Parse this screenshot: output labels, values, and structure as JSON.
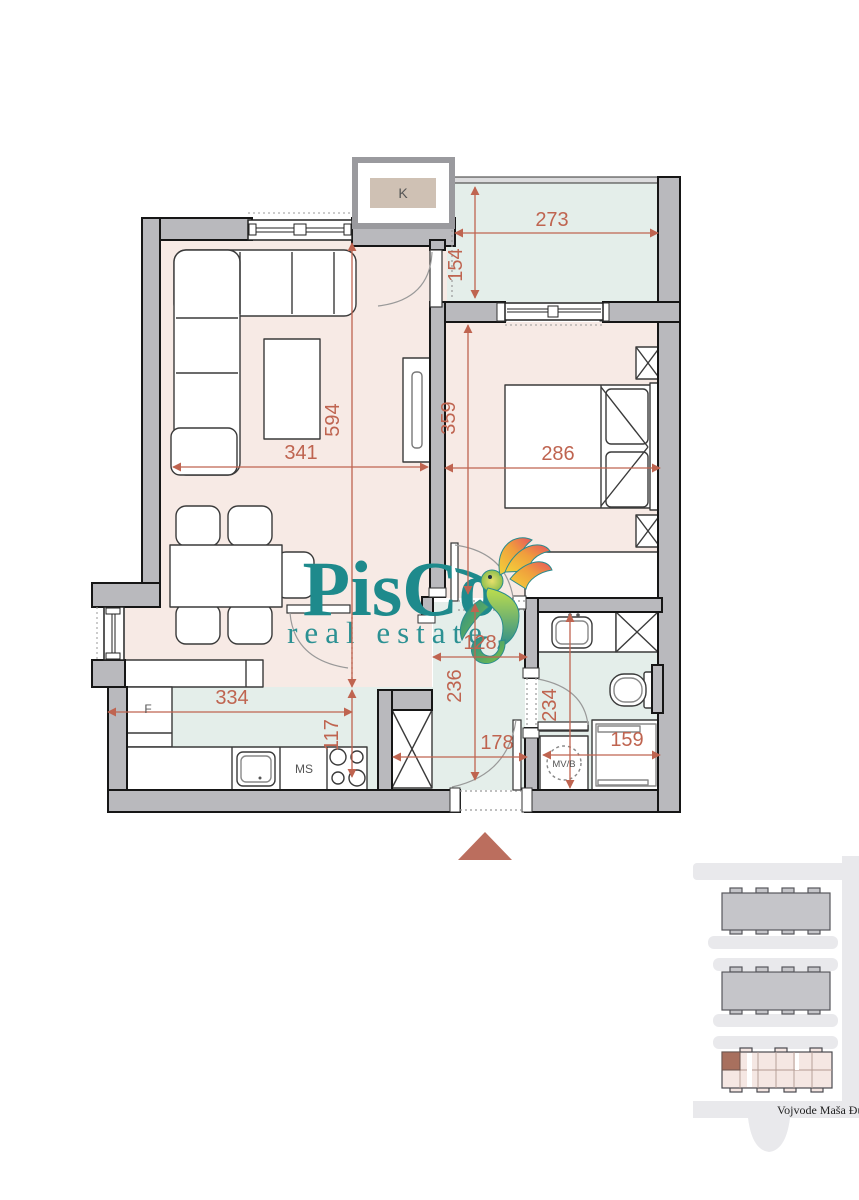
{
  "logo": {
    "brand": "PisCo",
    "tagline": "real estate",
    "accent_color": "#1e8a8c"
  },
  "floor_plan": {
    "appliance_labels": {
      "ac_unit": "K",
      "fridge": "F",
      "dishwasher": "MS",
      "washing_machine": "MV/B"
    },
    "dimensions": {
      "terrace_width": "273",
      "terrace_depth": "154",
      "living_length": "594",
      "living_width": "341",
      "bedroom_length": "359",
      "bedroom_width": "286",
      "hall_width": "128",
      "hall_length": "236",
      "entry_width": "178",
      "kitchen_width": "334",
      "kitchen_depth": "117",
      "bathroom_length": "234",
      "bathroom_width": "159"
    },
    "dimension_color": "#bf6450",
    "floor_colors": {
      "rooms": "#f7eae5",
      "wet_areas": "#e4eeea",
      "walls": "#b9b9bd"
    }
  },
  "site_map": {
    "street_name": "Vojvode Maša Đur",
    "highlight_color": "#a8705e"
  }
}
